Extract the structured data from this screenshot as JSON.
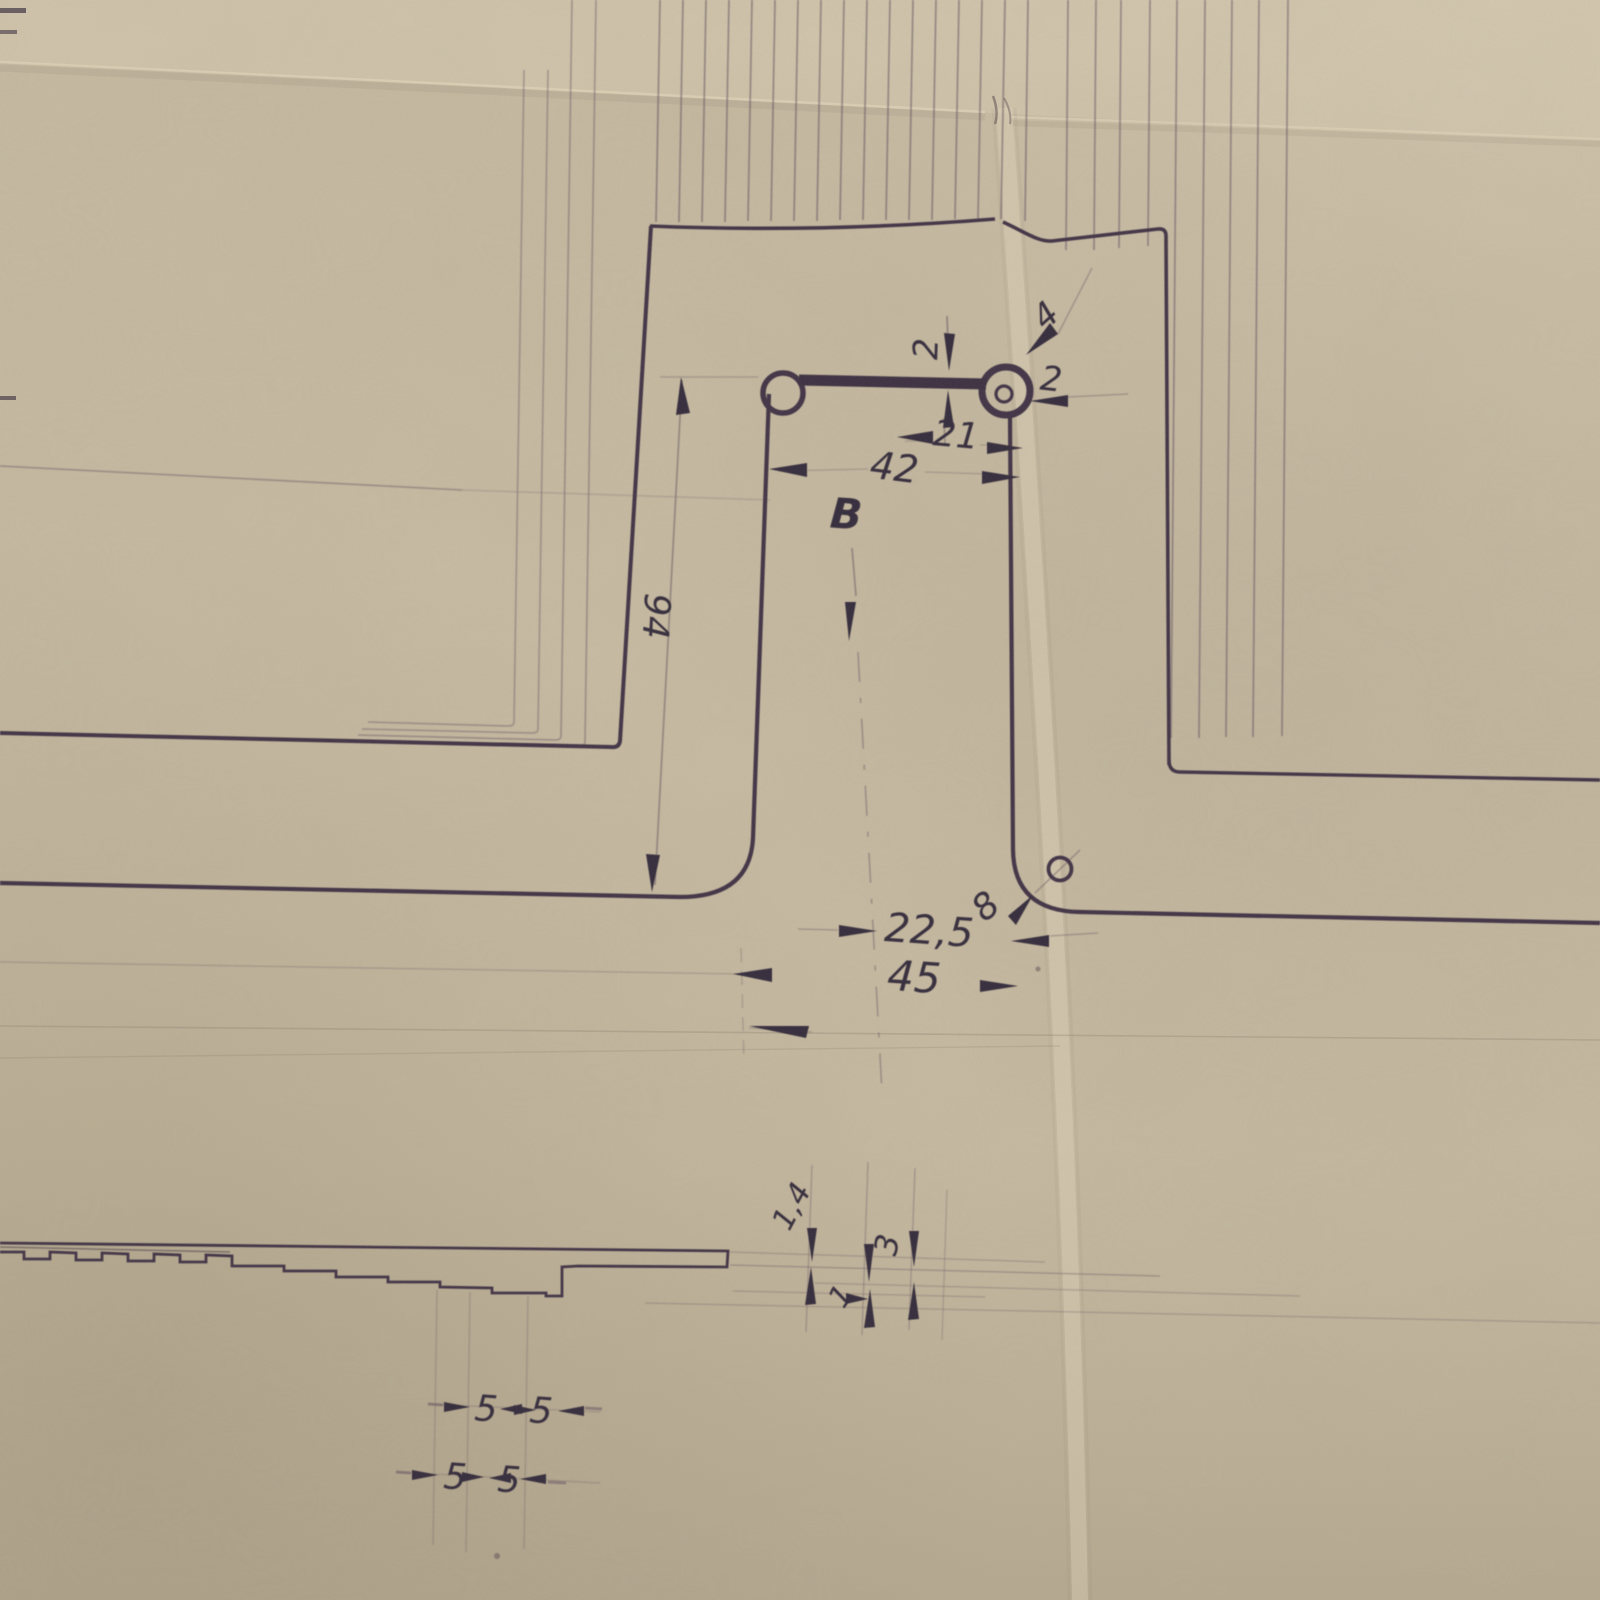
{
  "drawing": {
    "colors": {
      "paper": "#c9bda4",
      "ink": "#3a2e3e"
    },
    "section_marker": "B",
    "dimensions": {
      "slot_height": "2",
      "hole_diameter_top": "4",
      "edge_offset": "2",
      "center_to_edge": "21",
      "slot_length": "42",
      "column_height": "94",
      "half_width": "22,5",
      "corner_hole": "8",
      "width": "45",
      "sheet_thickness": "1,4",
      "step_depth": "3",
      "step_rise": "1",
      "pitch_row1": [
        "5",
        "5"
      ],
      "pitch_row2": [
        "5",
        "5"
      ]
    }
  }
}
